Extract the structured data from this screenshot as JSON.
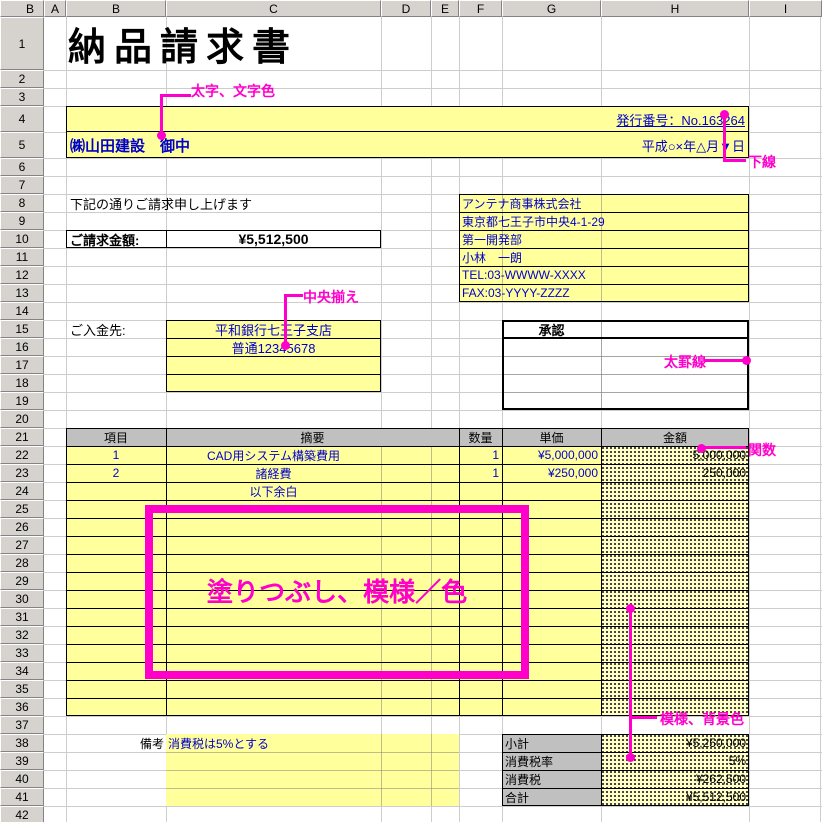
{
  "sheet": {
    "corner_label": "B",
    "columns": [
      "A",
      "B",
      "C",
      "D",
      "E",
      "F",
      "G",
      "H",
      "I"
    ],
    "rows": [
      "1",
      "2",
      "3",
      "4",
      "5",
      "6",
      "7",
      "8",
      "9",
      "10",
      "11",
      "12",
      "13",
      "14",
      "15",
      "16",
      "17",
      "18",
      "19",
      "20",
      "21",
      "22",
      "23",
      "24",
      "25",
      "26",
      "27",
      "28",
      "29",
      "30",
      "31",
      "32",
      "33",
      "34",
      "35",
      "36",
      "37",
      "38",
      "39",
      "40",
      "41",
      "42"
    ]
  },
  "title": "納品請求書",
  "header_band": {
    "issue_no": "発行番号：No.163264",
    "recipient": "㈱山田建設　御中",
    "date": "平成○×年△月▼日"
  },
  "intro": "下記の通りご請求申し上げます",
  "billing": {
    "label": "ご請求金額:",
    "amount": "¥5,512,500"
  },
  "sender": {
    "lines": [
      "アンテナ商事株式会社",
      "東京都七王子市中央4-1-29",
      "第一開発部",
      "小林　一朗",
      "TEL:03-WWWW-XXXX",
      "FAX:03-YYYY-ZZZZ"
    ]
  },
  "payment": {
    "label": "ご入金先:",
    "bank": "平和銀行七王子支店",
    "account": "普通12345678"
  },
  "approval": {
    "label": "承認"
  },
  "items_table": {
    "headers": [
      "項目",
      "摘要",
      "数量",
      "単価",
      "金額"
    ],
    "rows": [
      [
        "1",
        "CAD用システム構築費用",
        "1",
        "¥5,000,000",
        "5,000,000"
      ],
      [
        "2",
        "諸経費",
        "1",
        "¥250,000",
        "250,000"
      ]
    ],
    "blank_note": "以下余白"
  },
  "notes": {
    "label": "備考",
    "text": "消費税は5%とする"
  },
  "summary": {
    "rows": [
      [
        "小計",
        "¥5,250,000"
      ],
      [
        "消費税率",
        "5%"
      ],
      [
        "消費税",
        "¥262,500"
      ],
      [
        "合計",
        "¥5,512,500"
      ]
    ]
  },
  "annotations": {
    "bold_color": "太字、文字色",
    "underline": "下線",
    "center_align": "中央揃え",
    "thick_border": "太罫線",
    "function": "関数",
    "fill_pattern": "塗りつぶし、模様／色",
    "pattern_bg": "模様、背景色"
  },
  "colors": {
    "accent": "#ff00cc",
    "cell_yellow": "#ffff9c",
    "pattern_base": "#ffffc6",
    "text_blue": "#0000cc",
    "header_gray": "#c0c0c0",
    "chrome_gray": "#d6d3ce"
  }
}
